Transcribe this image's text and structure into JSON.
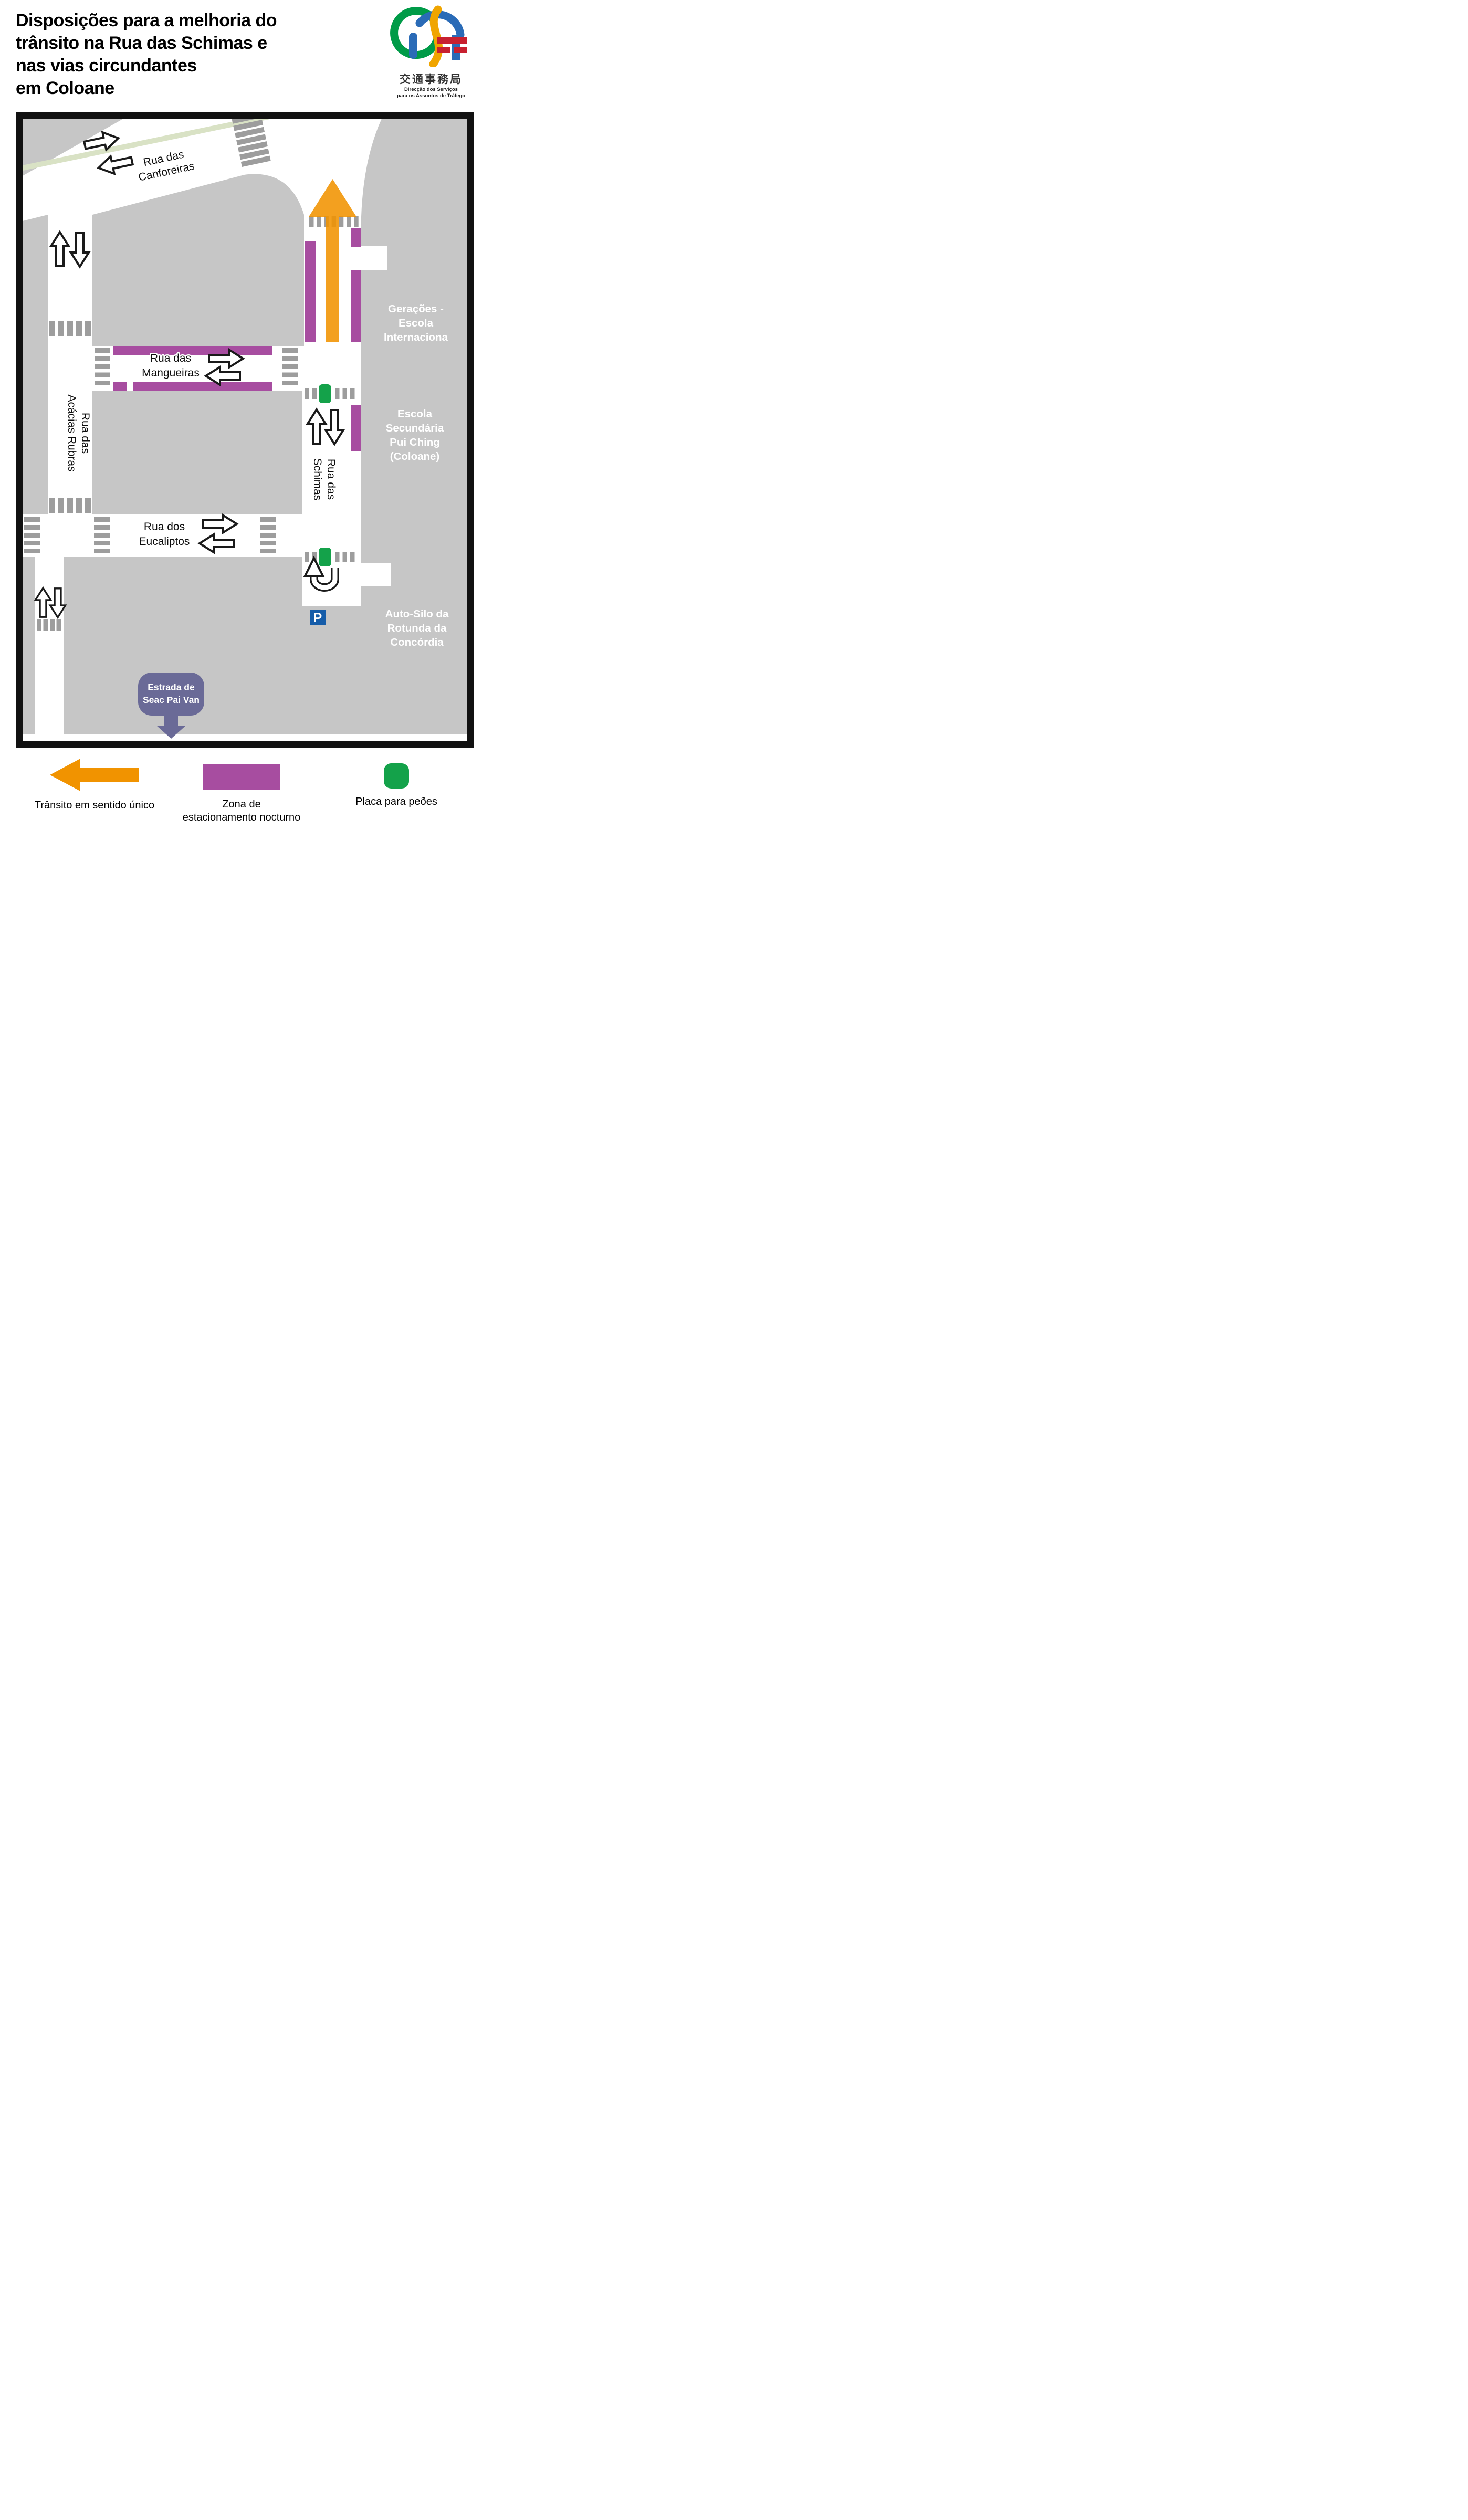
{
  "header": {
    "title_lines": [
      "Disposições para a melhoria do",
      "trânsito na Rua das Schimas e",
      "nas vias circundantes",
      "em Coloane"
    ],
    "logo": {
      "chinese": "交通事務局",
      "pt_line1": "Direcção  dos  Serviços",
      "pt_line2": "para os Assuntos de Tráfego"
    }
  },
  "map": {
    "streets": {
      "canforeiras": {
        "line1": "Rua das",
        "line2": "Canforeiras"
      },
      "mangueiras": {
        "line1": "Rua das",
        "line2": "Mangueiras"
      },
      "acacias": {
        "line1": "Rua das",
        "line2": "Acácias Rubras"
      },
      "eucaliptos": {
        "line1": "Rua dos",
        "line2": "Eucaliptos"
      },
      "schimas": {
        "line1": "Rua das",
        "line2": "Schimas"
      }
    },
    "places": {
      "geracoes": {
        "lines": [
          "Gerações -",
          "Escola",
          "Internaciona"
        ]
      },
      "escola_pui_ching": {
        "lines": [
          "Escola",
          "Secundária",
          "Pui Ching",
          "(Coloane)"
        ]
      },
      "auto_silo": {
        "lines": [
          "Auto-Silo da",
          "Rotunda da",
          "Concórdia"
        ]
      },
      "estrada_badge": {
        "line1": "Estrada de",
        "line2": "Seac Pai Van"
      }
    },
    "parking_symbol": "P"
  },
  "legend": {
    "one_way": {
      "label": "Trânsito em sentido único"
    },
    "night_parking": {
      "label_line1": "Zona de",
      "label_line2": "estacionamento nocturno"
    },
    "ped_plaque": {
      "label": "Placa para peões"
    }
  },
  "colors": {
    "block_gray": "#C6C6C6",
    "bar_gray": "#9D9D9D",
    "night_parking_purple": "#A74DA0",
    "one_way_orange": "#F19300",
    "ped_green": "#14A24A",
    "median_sage": "#D9E2C5",
    "badge_slate": "#6A6A97",
    "parking_blue": "#155CA9"
  }
}
